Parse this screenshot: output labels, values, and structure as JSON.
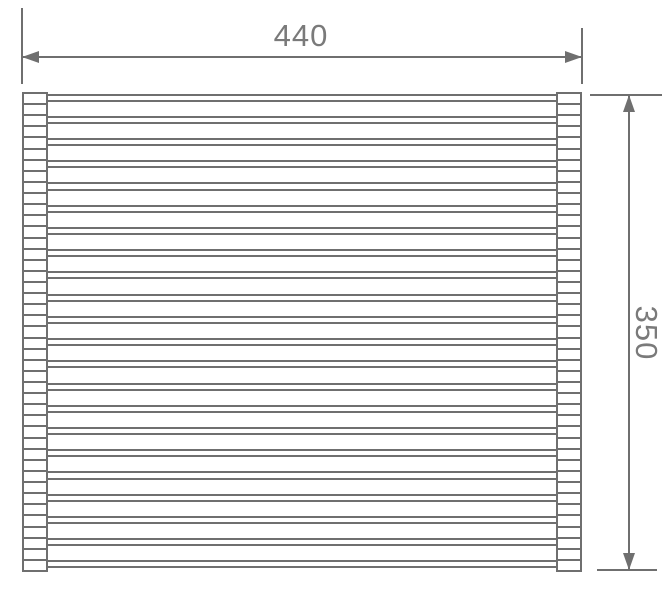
{
  "drawing": {
    "type": "technical-dimension-drawing",
    "subject": "roll-up rack front view",
    "dimensions": {
      "width": "440",
      "height": "350"
    },
    "rack": {
      "caps_per_side": 43,
      "rod_count": 22,
      "top": 92,
      "bottom": 570
    },
    "colors": {
      "line": "#6f6f6f",
      "text": "#7a7a7a",
      "background": "#ffffff"
    }
  }
}
